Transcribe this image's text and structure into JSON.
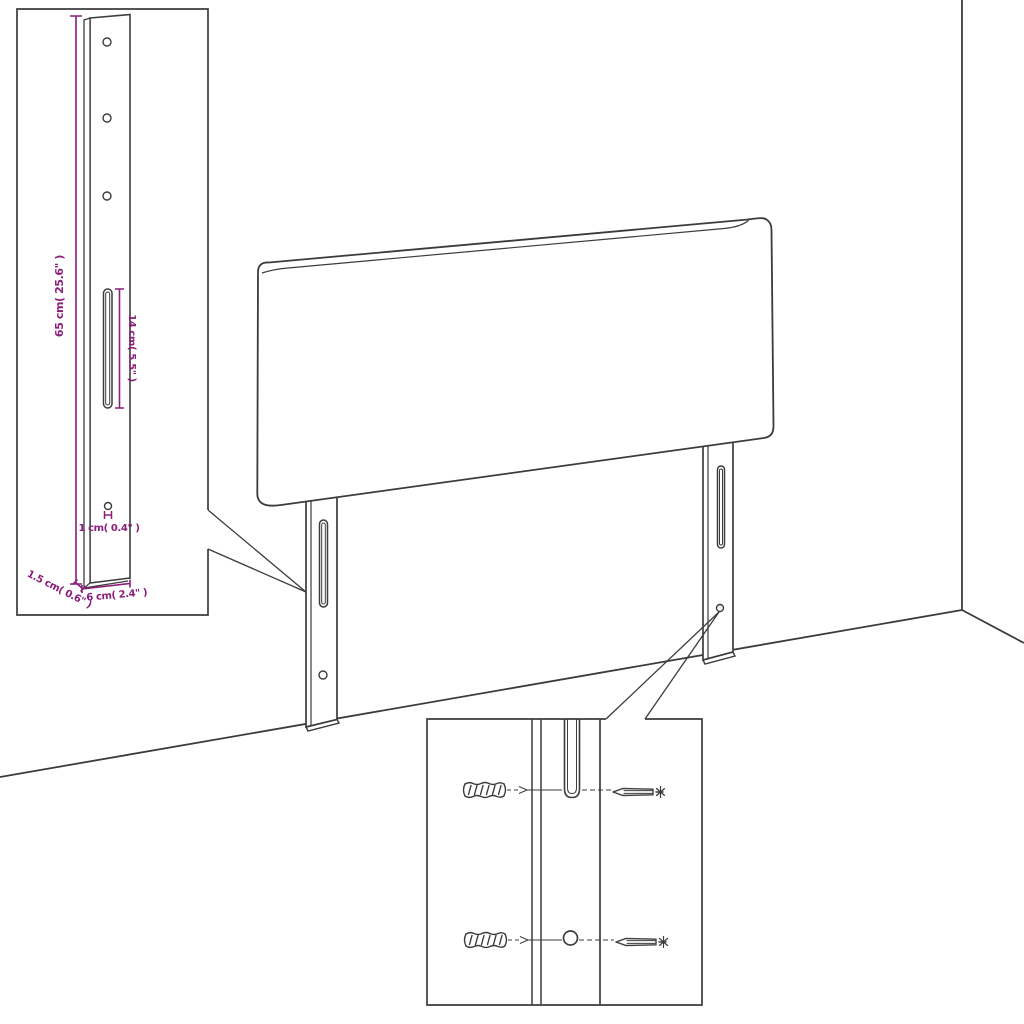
{
  "colors": {
    "line": "#3c3c3c",
    "dimension": "#8a1e7a",
    "background": "#ffffff"
  },
  "leg_detail_inset": {
    "labels": {
      "height": "65 cm( 25.6\" )",
      "slot": "14 cm( 5.5\" )",
      "hole": "1 cm( 0.4\" )",
      "thickness": "1.5 cm( 0.6\" )",
      "width": "6 cm( 2.4\" )"
    }
  }
}
